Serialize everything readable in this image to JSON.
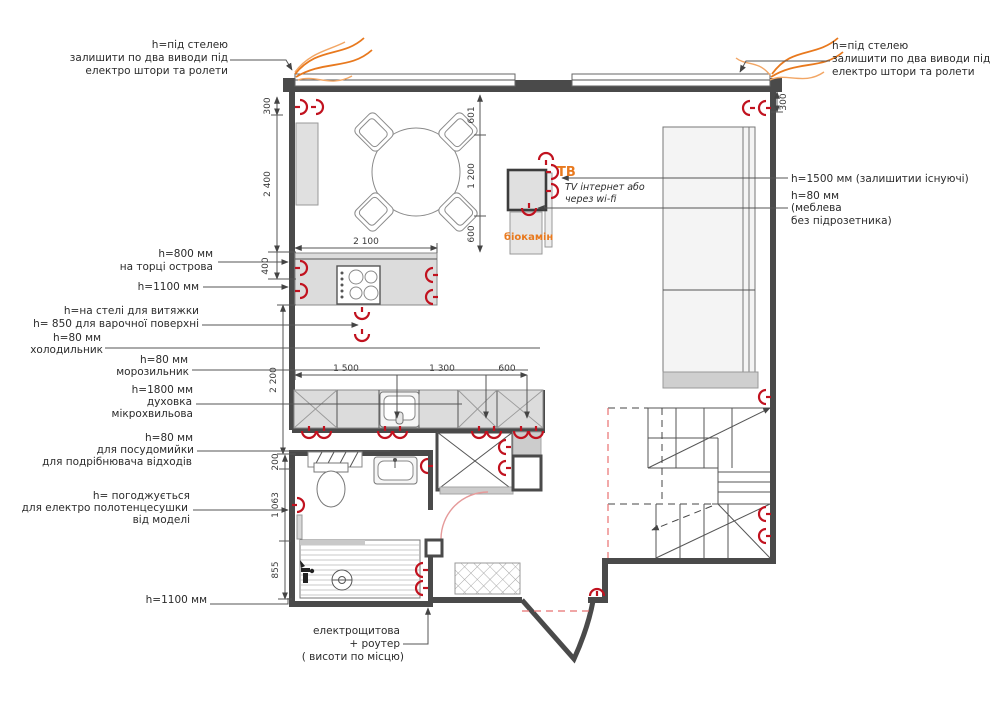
{
  "colors": {
    "outlet_red": "#c1121f",
    "accent_orange": "#e8791e",
    "wall_dark": "#4a4a4a",
    "door_arc_pink": "#e59a9a",
    "dashed_red": "#e87070"
  },
  "annotations": {
    "top_left": {
      "l1": "h=під стелею",
      "l2": "залишити по два виводи під",
      "l3": "електро штори та ролети"
    },
    "top_right": {
      "l1": "h=під стелею",
      "l2": "залишити по два виводи під",
      "l3": "електро штори та ролети"
    },
    "tv": {
      "label": "ТВ",
      "note1": "TV інтернет або",
      "note2": "через wi-fi",
      "fireplace": "біокамін"
    },
    "right": {
      "l1": "h=1500 мм (залишитии існуючі)",
      "l2": "h=80 мм",
      "l3": "(меблева",
      "l4": "без підрозетника)"
    },
    "island": {
      "l1": "h=800 мм",
      "l2": "на торці острова"
    },
    "h1100_top": "h=1100 мм",
    "hood": {
      "l1": "h=на стелі для витяжки",
      "l2": "h= 850 для варочної поверхні"
    },
    "fridge": {
      "l1": "h=80 мм",
      "l2": "холодильник"
    },
    "freezer": {
      "l1": "h=80 мм",
      "l2": "морозильник"
    },
    "oven": {
      "l1": "h=1800 мм",
      "l2": "духовка",
      "l3": "мікрохвильова"
    },
    "dishwasher": {
      "l1": "h=80 мм",
      "l2": "для посудомийки",
      "l3": "для подрібнювача відходів"
    },
    "towel": {
      "l1": "h= погоджується",
      "l2": "для електро полотенцесушки",
      "l3": "від моделі"
    },
    "h1100_bottom": "h=1100 мм",
    "panel": {
      "l1": "електрощитова",
      "l2": "+ роутер",
      "l3": "( висоти по місцю)"
    }
  },
  "dims": {
    "left300": "300",
    "v2400": "2 400",
    "v400": "400",
    "v2200": "2 200",
    "v200": "200",
    "v1063": "1 063",
    "v855": "855",
    "d601": "601",
    "d1200": "1 200",
    "d600": "600",
    "h2100": "2 100",
    "c1500": "1 500",
    "c1300": "1 300",
    "c600": "600",
    "right300": "300"
  }
}
